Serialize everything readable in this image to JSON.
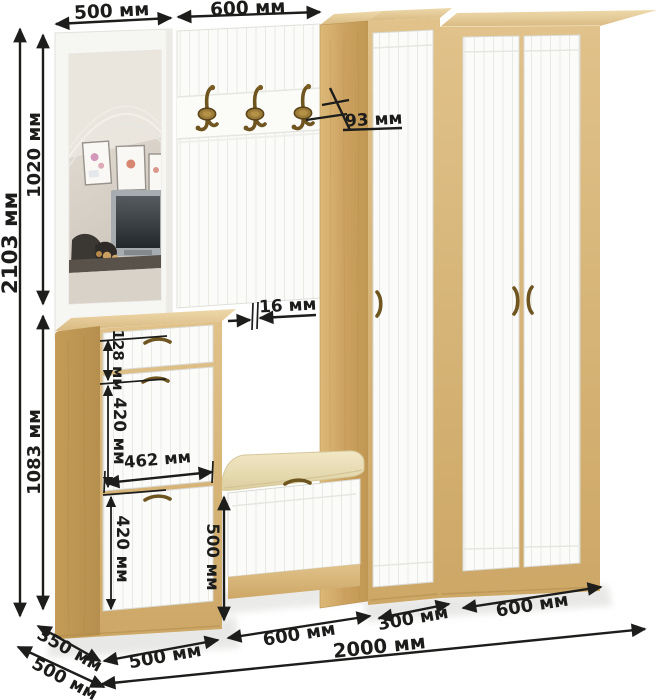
{
  "dims": {
    "mirror_width": "500 мм",
    "hook_panel_width": "600 мм",
    "total_height": "2103 мм",
    "upper_section_height": "1020 мм",
    "lower_section_height": "1083 мм",
    "hook_projection": "93 мм",
    "panel_thickness": "16 мм",
    "drawer_height": "128 мм",
    "upper_flap_height": "420 мм",
    "cabinet_inner_width": "462 мм",
    "lower_flap_height": "420 мм",
    "bench_height": "500 мм",
    "cabinet_depth": "350 мм",
    "total_depth": "500 мм",
    "shoe_cabinet_width": "500 мм",
    "bench_width": "600 мм",
    "narrow_wardrobe_width": "300 мм",
    "wide_wardrobe_width": "600 мм",
    "total_width": "2000 мм"
  },
  "colors": {
    "wood": "#d3ab6b",
    "wood_dark": "#bb9350",
    "wood_light": "#e9d4a5",
    "front_white": "#fbfbf9",
    "cushion": "#ecdfb8",
    "bronze": "#7a5c22",
    "dimension_line": "#1d1d1b"
  }
}
